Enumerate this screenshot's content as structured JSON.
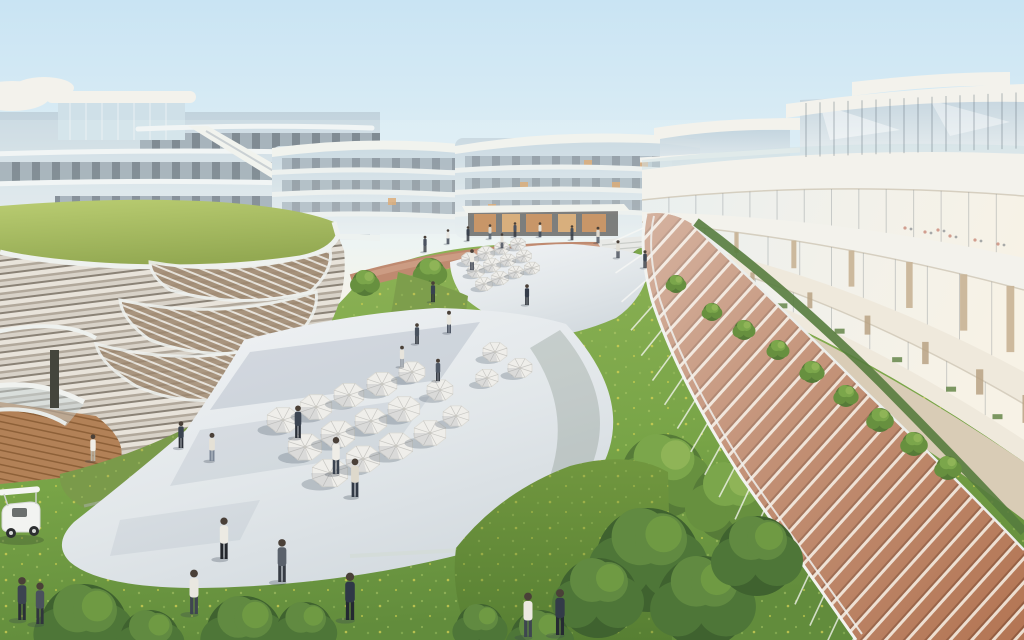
{
  "scene": {
    "description": "Aerial architectural rendering of a curved white mixed-use complex: green-roof podium left, curved balcony building right with glass pergola promenade, central paved plaza with white cafe umbrellas, palm groves, lawns and pedestrians under a pale blue sky",
    "palette": {
      "sky_top": "#c9e4f3",
      "sky_mid": "#dcedf5",
      "sky_horizon": "#eef4f2",
      "sky_warm": "#f5f3ea",
      "glass_cool": "#b9ccd8",
      "glass_pale": "#dde8ec",
      "facade_dark": "#57626d",
      "slab_white": "#f3f2ec",
      "slab_cream": "#efe9dc",
      "lawn_roof": "#a9bd62",
      "grass_mid": "#84ab50",
      "grass_dark": "#628c3c",
      "meadow": "#7a9a4a",
      "flower_yellow": "#d9d454",
      "plaza_light": "#f1f3f5",
      "plaza_mid": "#dde3e7",
      "plaza_shadow": "#b9c3cb",
      "terracotta_path": "#bf8a70",
      "pergola_deck": "#b06f4c",
      "pergola_stripe": "#ecdccd",
      "wood_deck": "#b28157",
      "hedge_green": "#567c3e",
      "palm_dark": "#4c6a33",
      "palm_mid": "#5f8440",
      "palm_light": "#739b4b",
      "tree_dark": "#3f622f",
      "umbrella_white": "#efeeea",
      "people_navy": "#333b49",
      "people_white": "#eceae3",
      "cart_white": "#f2f3f1",
      "base_wall": "#d9ccb6",
      "lit_window": "#d89a58"
    },
    "umbrellas_main": [
      [
        283,
        420,
        17
      ],
      [
        316,
        407,
        17
      ],
      [
        349,
        395,
        16
      ],
      [
        382,
        384,
        16
      ],
      [
        305,
        447,
        18
      ],
      [
        338,
        434,
        18
      ],
      [
        371,
        421,
        17
      ],
      [
        404,
        409,
        17
      ],
      [
        330,
        473,
        19
      ],
      [
        363,
        459,
        18
      ],
      [
        396,
        446,
        18
      ],
      [
        430,
        433,
        17
      ],
      [
        412,
        372,
        14
      ],
      [
        440,
        390,
        14
      ],
      [
        456,
        416,
        14
      ],
      [
        495,
        352,
        13
      ],
      [
        520,
        368,
        13
      ],
      [
        487,
        378,
        12
      ]
    ],
    "umbrellas_upper": [
      [
        470,
        259,
        9
      ],
      [
        486,
        253,
        9
      ],
      [
        502,
        248,
        8
      ],
      [
        518,
        244,
        8
      ],
      [
        476,
        271,
        9
      ],
      [
        492,
        265,
        9
      ],
      [
        508,
        260,
        8
      ],
      [
        524,
        256,
        8
      ],
      [
        484,
        284,
        9
      ],
      [
        500,
        278,
        9
      ],
      [
        516,
        272,
        8
      ],
      [
        532,
        268,
        8
      ]
    ],
    "palms_bg": [
      [
        160,
        216,
        0.45,
        1
      ],
      [
        198,
        217,
        0.5,
        2
      ],
      [
        243,
        215,
        0.5,
        1
      ],
      [
        332,
        218,
        0.45,
        2
      ],
      [
        300,
        235,
        0.6,
        1
      ],
      [
        470,
        213,
        0.5,
        1
      ],
      [
        506,
        216,
        0.55,
        2
      ],
      [
        542,
        214,
        0.5,
        1
      ],
      [
        578,
        214,
        0.55,
        2
      ],
      [
        612,
        214,
        0.45,
        1
      ],
      [
        375,
        280,
        0.95,
        1
      ],
      [
        410,
        273,
        0.85,
        2
      ],
      [
        448,
        271,
        0.7,
        1
      ]
    ],
    "palms_grove": [
      [
        532,
        321,
        1.0,
        1
      ],
      [
        562,
        328,
        1.35,
        2
      ],
      [
        612,
        291,
        1.2,
        1
      ],
      [
        648,
        341,
        1.5,
        2
      ],
      [
        628,
        240,
        0.95,
        1
      ],
      [
        668,
        265,
        1.1,
        2
      ],
      [
        700,
        386,
        1.4,
        1
      ],
      [
        590,
        380,
        1.3,
        2
      ],
      [
        633,
        276,
        1.05,
        1
      ],
      [
        702,
        263,
        1.15,
        2
      ],
      [
        279,
        338,
        1.05,
        1
      ],
      [
        342,
        331,
        0.9,
        2
      ]
    ],
    "palms_fg": [
      [
        590,
        490,
        2.1,
        1
      ],
      [
        654,
        450,
        2.4,
        2
      ],
      [
        720,
        537,
        2.2,
        1
      ],
      [
        874,
        484,
        3.0,
        2
      ],
      [
        944,
        574,
        2.0,
        1
      ],
      [
        830,
        572,
        2.3,
        2
      ]
    ],
    "trees_mid": [
      [
        430,
        273,
        15,
        1
      ],
      [
        498,
        264,
        13,
        1
      ],
      [
        562,
        259,
        13,
        1
      ],
      [
        644,
        263,
        15,
        1
      ],
      [
        692,
        272,
        13,
        1
      ],
      [
        365,
        283,
        13,
        1
      ],
      [
        183,
        484,
        20,
        1
      ],
      [
        232,
        464,
        17,
        1
      ],
      [
        273,
        442,
        15,
        1
      ],
      [
        312,
        417,
        13,
        1
      ],
      [
        205,
        502,
        19,
        1
      ],
      [
        663,
        476,
        42,
        1
      ],
      [
        612,
        502,
        38,
        1
      ],
      [
        731,
        502,
        40,
        1
      ],
      [
        565,
        470,
        30,
        1
      ]
    ],
    "trees_fg": [
      [
        648,
        560,
        52,
        0
      ],
      [
        703,
        602,
        46,
        0
      ],
      [
        598,
        598,
        40,
        0
      ],
      [
        757,
        556,
        40,
        0
      ],
      [
        244,
        634,
        38,
        0
      ],
      [
        84,
        628,
        44,
        0
      ],
      [
        305,
        630,
        28,
        0
      ],
      [
        150,
        640,
        30,
        0
      ],
      [
        540,
        640,
        30,
        0
      ],
      [
        480,
        628,
        24,
        0
      ]
    ],
    "hedges": [
      [
        712,
        312,
        9
      ],
      [
        744,
        330,
        10
      ],
      [
        778,
        350,
        10
      ],
      [
        812,
        372,
        11
      ],
      [
        846,
        396,
        11
      ],
      [
        880,
        420,
        12
      ],
      [
        914,
        444,
        12
      ],
      [
        948,
        468,
        12
      ],
      [
        676,
        284,
        9
      ]
    ],
    "people": [
      [
        448,
        244,
        0.5,
        "#e8e6e0",
        "#3a4250"
      ],
      [
        468,
        241,
        0.5,
        "#39414e",
        "#2c313a"
      ],
      [
        490,
        239,
        0.5,
        "#d8d5cc",
        "#55616e"
      ],
      [
        515,
        237,
        0.5,
        "#4a5260",
        "#32363e"
      ],
      [
        540,
        237,
        0.5,
        "#e4e2da",
        "#3c4654"
      ],
      [
        572,
        240,
        0.5,
        "#434c58",
        "#2e333c"
      ],
      [
        598,
        243,
        0.55,
        "#ddd9d0",
        "#474f5c"
      ],
      [
        425,
        252,
        0.55,
        "#4a5260",
        "#32363e"
      ],
      [
        502,
        248,
        0.5,
        "#e6e3db",
        "#3f4754"
      ],
      [
        618,
        258,
        0.6,
        "#e2dfd6",
        "#3e4551"
      ],
      [
        645,
        268,
        0.6,
        "#3f4754",
        "#2b2f38"
      ],
      [
        472,
        270,
        0.7,
        "#eceae2",
        "#3c4250"
      ],
      [
        527,
        305,
        0.7,
        "#343c4a",
        "#262b33"
      ],
      [
        433,
        302,
        0.7,
        "#384150",
        "#262b33"
      ],
      [
        449,
        333,
        0.75,
        "#e9e7df",
        "#4a5260"
      ],
      [
        417,
        344,
        0.7,
        "#49525f",
        "#2e333c"
      ],
      [
        402,
        367,
        0.72,
        "#e7e4dc",
        "#99a0a8"
      ],
      [
        438,
        381,
        0.75,
        "#505966",
        "#31363f"
      ],
      [
        93,
        461,
        0.9,
        "#efede6",
        "#b9b3a4"
      ],
      [
        181,
        448,
        0.9,
        "#3a4350",
        "#2a2f37"
      ],
      [
        212,
        461,
        0.95,
        "#e5e1d6",
        "#7b8696"
      ],
      [
        298,
        438,
        1.1,
        "#3c4552",
        "#2b3039"
      ],
      [
        336,
        474,
        1.25,
        "#efede7",
        "#3b434f"
      ],
      [
        355,
        497,
        1.3,
        "#ded9cc",
        "#323a46"
      ],
      [
        224,
        559,
        1.4,
        "#eceae3",
        "#23262c"
      ],
      [
        282,
        582,
        1.45,
        "#5a616b",
        "#373c44"
      ],
      [
        350,
        620,
        1.6,
        "#2f3847",
        "#232831"
      ],
      [
        194,
        614,
        1.5,
        "#e9e7e0",
        "#3f4550"
      ],
      [
        528,
        637,
        1.5,
        "#ece9e1",
        "#3e4650"
      ],
      [
        560,
        635,
        1.55,
        "#333b49",
        "#252a32"
      ],
      [
        22,
        620,
        1.45,
        "#3c4350",
        "#2b2f37"
      ],
      [
        40,
        624,
        1.4,
        "#4a515d",
        "#30353d"
      ]
    ],
    "glass_reflection_people": [
      [
        905,
        228
      ],
      [
        925,
        232
      ],
      [
        950,
        236
      ],
      [
        975,
        240
      ],
      [
        998,
        244
      ],
      [
        938,
        230
      ]
    ],
    "golf_cart": {
      "x": 0,
      "y": 486
    }
  }
}
